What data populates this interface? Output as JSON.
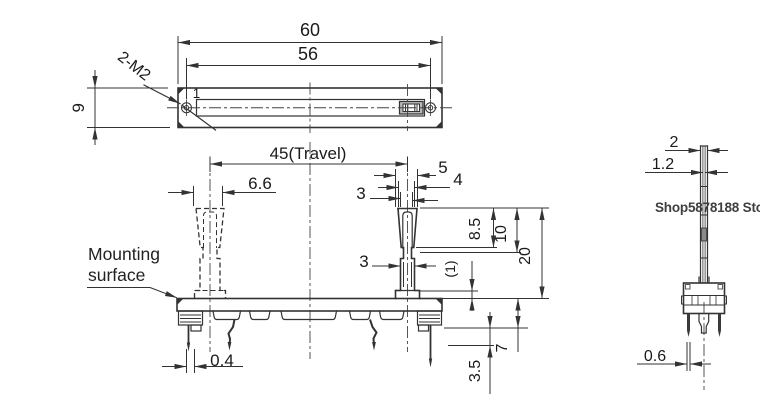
{
  "watermark": {
    "text": "Shop5878188 Store",
    "color": "#3f3f3f"
  },
  "annotations": {
    "mounting_line1": "Mounting",
    "mounting_line2": "surface",
    "thread_note": "2-M2",
    "slot_note": "1"
  },
  "dims": {
    "top": {
      "overall_width": "60",
      "hole_pitch": "56",
      "body_height": "9"
    },
    "front": {
      "travel": "45(Travel)",
      "lever_base_width": "6.6",
      "tip_5": "5",
      "tip_4": "4",
      "tip_3": "3",
      "stem_3": "3",
      "h_8_5": "8.5",
      "h_10": "10",
      "h_20": "20",
      "clearance": "(1)",
      "pin_thickness": "0.4",
      "pin_tip": "3.5",
      "pin_length": "7"
    },
    "side": {
      "lever_thickness": "2",
      "inner_thickness": "1.2",
      "pin_thickness": "0.6"
    }
  },
  "colors": {
    "line": "#333333",
    "background": "#ffffff",
    "slider_fill": "#b9b9b9",
    "pin_fill": "#3a3a3a"
  }
}
